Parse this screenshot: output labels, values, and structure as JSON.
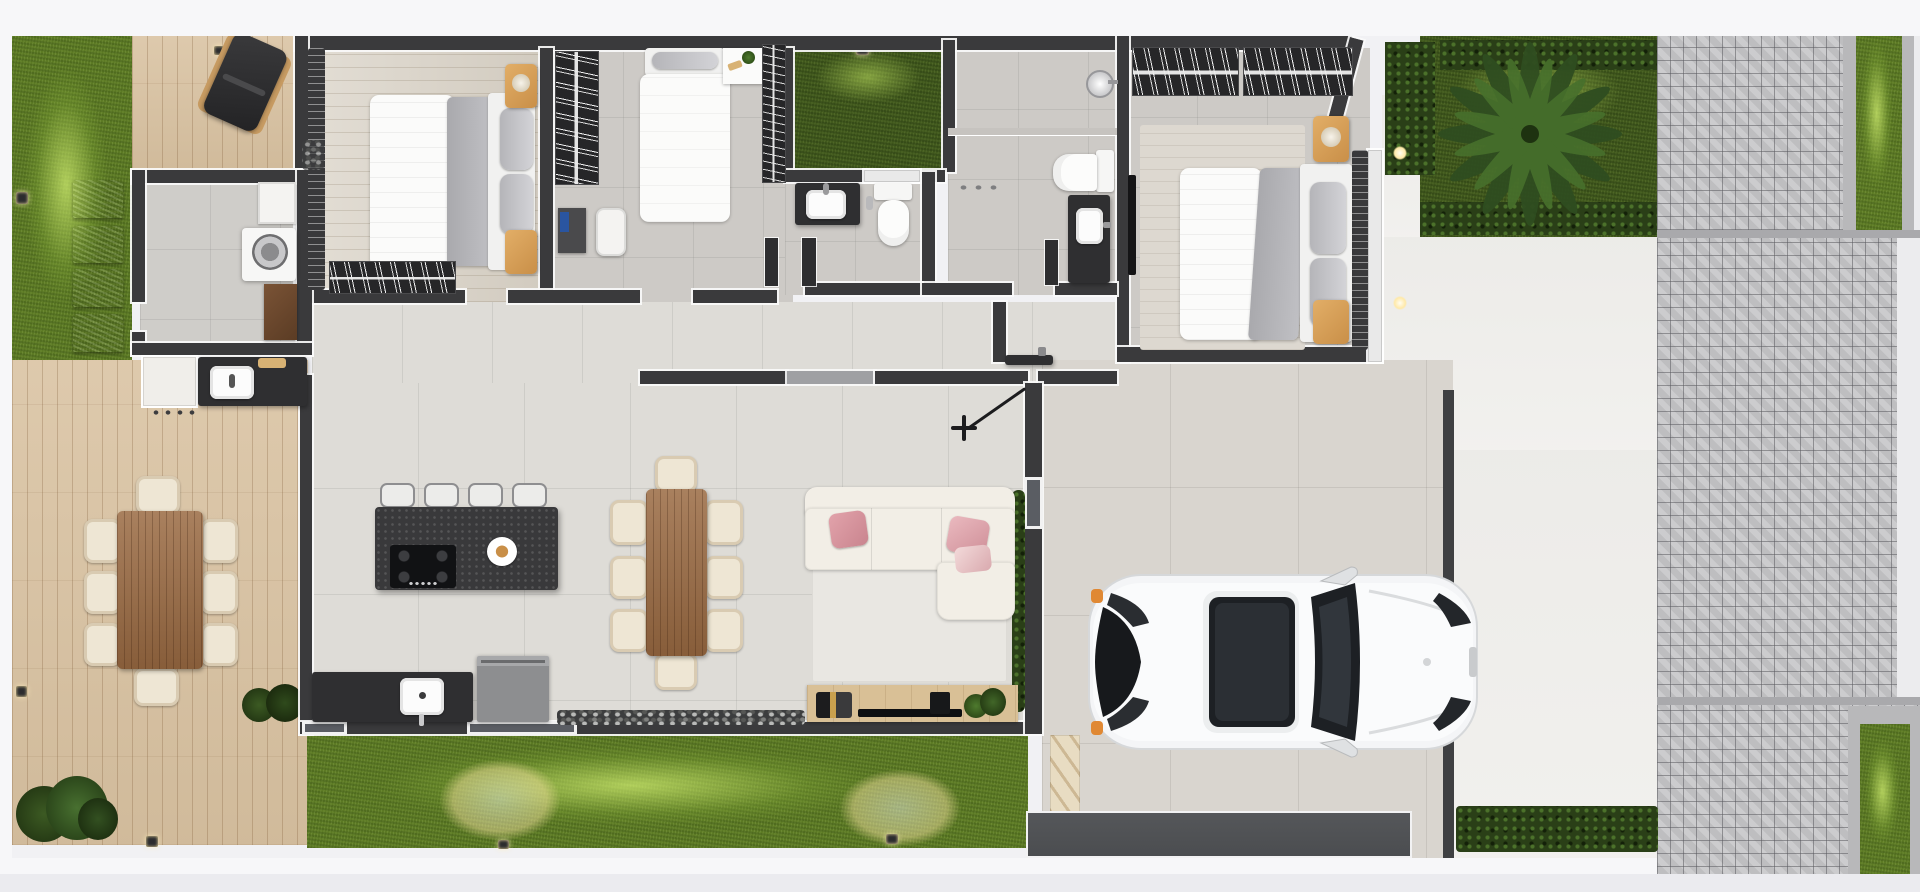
{
  "palette": {
    "c-bg": "#f1f1f4",
    "c-margin": "#f7f7f9",
    "c-wall": "#3a3a3c",
    "c-grass": "#5c7a24",
    "c-grass-dark": "#41591d",
    "c-hedge": "#2a3f17",
    "c-deck": "#d9c2a1",
    "c-tile": "#dedcd7",
    "c-bedfloor": "#d9d2c6",
    "c-paver": "#c8c8ca",
    "c-concrete": "#f1f0ed",
    "c-garage": "#d9d5cf",
    "c-accent-wood": "#dba45e",
    "c-pink": "#e2a3ab",
    "c-car": "#f6f7f8",
    "c-gate": "#4b4d50"
  },
  "scene": {
    "type": "top-view 3D rendered residential floor plan",
    "rooms": {
      "side_lawn": {
        "label": "side lawn with stepping stones"
      },
      "deck": {
        "label": "wooden deck with outdoor dining table for eight"
      },
      "laundry": {
        "label": "laundry room with washer and cabinets"
      },
      "outdoor_kitchen": {
        "label": "outdoor kitchen counter with sink"
      },
      "bedroom1": {
        "label": "bedroom with double bed, nightstands and wardrobe rail"
      },
      "bedroom2": {
        "label": "bedroom with single bed, desk and closet rails"
      },
      "courtyard": {
        "label": "internal grass courtyard"
      },
      "bathroom": {
        "label": "bathroom with vanity and toilet"
      },
      "ensuite": {
        "label": "ensuite bathroom with shower, toilet and vanity"
      },
      "master_bedroom": {
        "label": "master bedroom with double bed, rug and closet rails"
      },
      "corridor": {
        "label": "hallway connecting bedrooms to living area"
      },
      "kitchen": {
        "label": "kitchen with island, cooktop, stools, sink counter and fridge"
      },
      "dining": {
        "label": "indoor dining table with eight chairs"
      },
      "living": {
        "label": "living room with L-shaped sofa, rug and TV console"
      },
      "front_lawn": {
        "label": "front lawn strip with uplights"
      },
      "garage": {
        "label": "carport with white SUV, entry steps and gate"
      },
      "palm_garden": {
        "label": "front garden with palm tree and hedges"
      },
      "walkway": {
        "label": "white side walkway with recessed lights"
      },
      "sidewalk": {
        "label": "paved public sidewalk with grass verge and corner planter"
      }
    },
    "objects": [
      "lounge-chair",
      "washing-machine",
      "storage-cabinet",
      "outdoor-sink",
      "double-bed",
      "single-bed",
      "desk",
      "bookshelf",
      "office-chair",
      "hanger-rails",
      "vanity-sink",
      "toilet",
      "shower-head",
      "sliding-door",
      "kitchen-island",
      "gas-cooktop",
      "bar-stools",
      "kitchen-sink",
      "fridge",
      "dining-table",
      "dining-chairs",
      "sofa",
      "pink-pillows",
      "tv-console",
      "tv",
      "ceiling-fan",
      "white-suv",
      "entry-steps",
      "garage-gate",
      "palm-tree",
      "stepping-stones",
      "garden-uplights",
      "pebble-strips",
      "potted-plants"
    ]
  }
}
